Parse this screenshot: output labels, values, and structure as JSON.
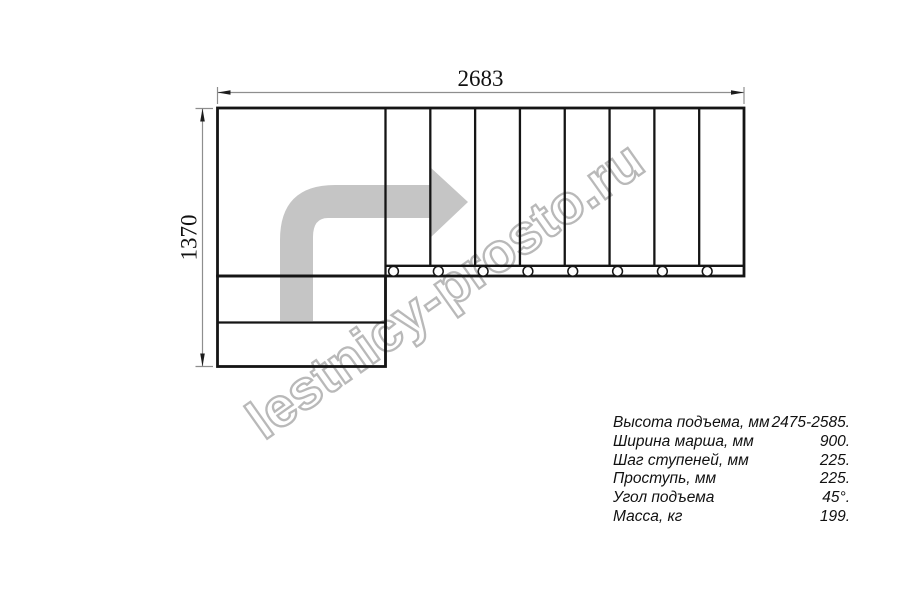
{
  "drawing": {
    "width_dimension": "2683",
    "height_dimension": "1370",
    "visible_steps": 8,
    "direction_arrow": "turn-right"
  },
  "watermark": {
    "text": "lestnicy-prosto.ru"
  },
  "specs": {
    "rows": [
      {
        "label": "Высота подъема, мм",
        "value": "2475-2585."
      },
      {
        "label": "Ширина марша, мм",
        "value": "900."
      },
      {
        "label": "Шаг ступеней, мм",
        "value": "225."
      },
      {
        "label": "Проступь, мм",
        "value": "225."
      },
      {
        "label": "Угол подъема",
        "value": "45°."
      },
      {
        "label": "Масса, кг",
        "value": "199."
      }
    ]
  },
  "colors": {
    "line": "#151515",
    "dim": "#8e8e8e",
    "arrow_fill": "#c5c5c5",
    "watermark_stroke": "#b9b9b9",
    "text": "#111111"
  }
}
